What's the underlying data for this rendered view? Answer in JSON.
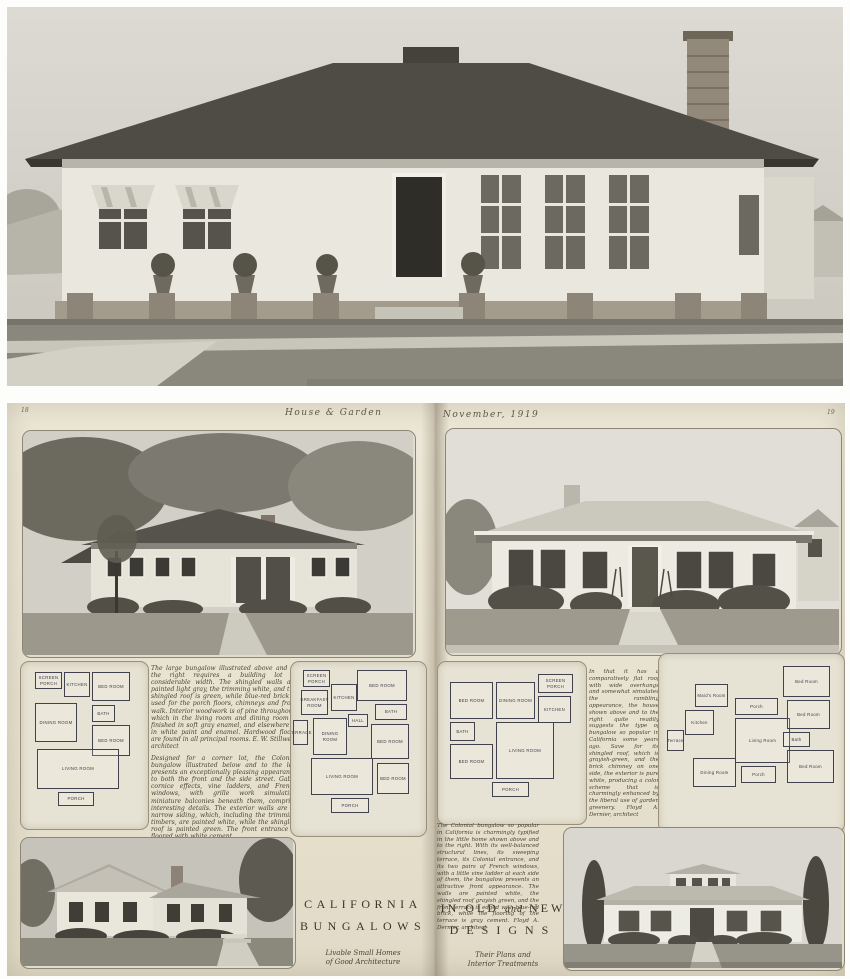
{
  "header": {
    "page_number_left": "18",
    "magazine_title": "House & Garden",
    "issue_date": "November, 1919",
    "page_number_right": "19"
  },
  "left_page": {
    "paragraph_top": "The large bungalow illustrated above and to the right requires a building lot of considerable width. The shingled walls are painted light gray, the trimming white, and the shingled roof is green, while blue-red brick is used for the porch floors, chimneys and front walk. Interior woodwork is of pine throughout, which in the living room and dining room is finished in soft gray enamel, and elsewhere is in white paint and enamel. Hardwood floors are found in all principal rooms.  E. W. Stillwell, architect",
    "paragraph_bottom": "Designed for a corner lot, the Colonial bungalow illustrated below and to the left presents an exceptionally pleasing appearance to both the front and the side street. Gable cornice effects, vine ladders, and French windows, with grille work simulating miniature balconies beneath them, comprise interesting details. The exterior walls are of narrow siding, which, including the trimming timbers, are painted white, while the shingled roof is painted green. The front entrance is floored with white cement",
    "title_line1": "CALIFORNIA",
    "title_line2": "BUNGALOWS",
    "subtitle_line1": "Livable Small Homes",
    "subtitle_line2": "of Good Architecture",
    "plan_small": {
      "rooms": [
        "SCREEN PORCH",
        "KITCHEN",
        "BED ROOM",
        "DINING ROOM",
        "BATH",
        "BED ROOM",
        "LIVING ROOM",
        "PORCH"
      ]
    },
    "plan_large": {
      "rooms": [
        "SCREEN PORCH",
        "BED ROOM",
        "BREAKFAST ROOM",
        "KITCHEN",
        "BATH",
        "HALL",
        "TERRACE",
        "DINING ROOM",
        "BED ROOM",
        "LIVING ROOM",
        "BED ROOM",
        "PORCH"
      ]
    }
  },
  "right_page": {
    "paragraph_middle": "In that it has a comparatively flat roof with wide overhangs and somewhat simulates the rambling appearance, the house shown above and to the right quite readily suggests the type of bungalow so popular in California some years ago. Save for its shingled roof, which is grayish-green, and the brick chimney on one side, the exterior is pure white, producing a color scheme that is charmingly enhanced by the liberal use of garden greenery.  Floyd A. Dernier, architect",
    "paragraph_bottom": "The Colonial bungalow so popular in California is charmingly typified in the little home shown above and to the right. With its well-balanced structural lines, its sweeping terrace, its Colonial entrance, and its two pairs of French windows, with a little vine ladder at each side of them, the bungalow presents an attractive front appearance. The walls are painted white, the shingled roof grayish green, and the front terrace is edged with blue-red brick, while the flooring of the terrace is gray cement.  Floyd A. Dernier, architect",
    "title_part1": "IN OLD",
    "title_conj": "and",
    "title_part2": "NEW",
    "title_line2": "DESIGNS",
    "subtitle_line1": "Their Plans and",
    "subtitle_line2": "Interior Treatments",
    "plan_left": {
      "rooms": [
        "BED ROOM",
        "DINING ROOM",
        "SCREEN PORCH",
        "KITCHEN",
        "BATH",
        "BED ROOM",
        "LIVING ROOM",
        "PORCH"
      ]
    },
    "plan_right": {
      "rooms": [
        "Maid's Room",
        "Kitchen",
        "Terrace",
        "Dining Room",
        "Porch",
        "Living Room",
        "Porch",
        "Bed Room",
        "Bed Room",
        "Bath",
        "Bed Room"
      ]
    }
  },
  "colors": {
    "paper": "#e9e3d1",
    "ink": "#4c4334",
    "plan_ink": "#3d3d49",
    "photo_roof": "#4e4c45"
  }
}
